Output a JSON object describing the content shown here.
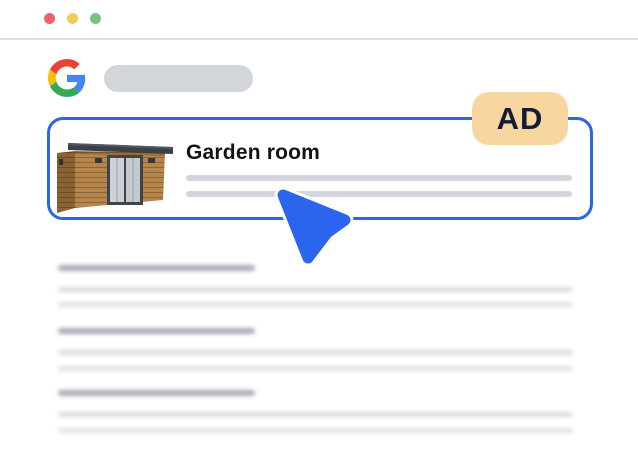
{
  "window": {
    "traffic_lights": [
      {
        "name": "close",
        "color": "#f1606b"
      },
      {
        "name": "minimize",
        "color": "#f0cd52"
      },
      {
        "name": "zoom",
        "color": "#77c37c"
      }
    ],
    "divider_color": "#dcdfe3"
  },
  "header": {
    "logo_icon": "google-g-icon",
    "search_pill": "empty-skeleton"
  },
  "ad_card": {
    "title": "Garden room",
    "badge_label": "AD",
    "image_name": "garden-room-3d-cabin",
    "description_skeleton_lines": 2,
    "colors": {
      "border": "#2b64ed",
      "badge_bg": "#f8d6a0",
      "badge_text": "#141b35",
      "skeleton_line": "#d2d5db"
    }
  },
  "cursor": {
    "icon": "pointer-cursor-icon",
    "color": "#2b64ed"
  },
  "results_skeleton": {
    "count": 3,
    "lines_per_item": 3,
    "title_bar_color": "#a6abb4",
    "line_bar_color": "#d8dbdf"
  }
}
